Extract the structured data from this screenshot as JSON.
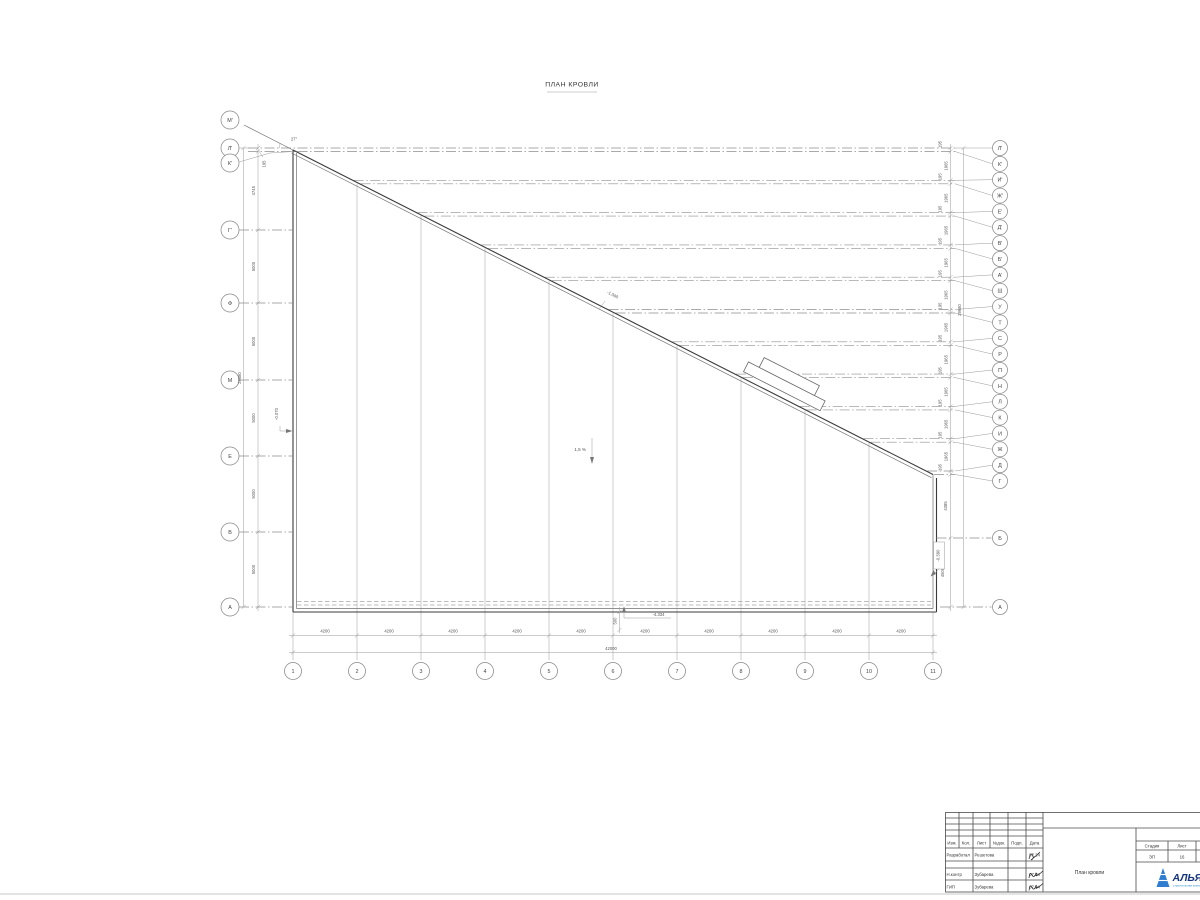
{
  "title": "ПЛАН КРОВЛИ",
  "axes": {
    "left": [
      "М'",
      "Л'",
      "К'",
      "Г'",
      "Ф",
      "М",
      "Е",
      "В",
      "А"
    ],
    "right": [
      "Л'",
      "К'",
      "И'",
      "Ж'",
      "Е'",
      "Д'",
      "В'",
      "Б'",
      "А'",
      "Ш",
      "У",
      "Т",
      "С",
      "Р",
      "П",
      "Н",
      "Л",
      "К",
      "И",
      "Ж",
      "Д",
      "Г"
    ],
    "right_lower": [
      "Б",
      "А"
    ],
    "bottom": [
      "1",
      "2",
      "3",
      "4",
      "5",
      "6",
      "7",
      "8",
      "9",
      "10",
      "11"
    ]
  },
  "dims": {
    "left_chain": [
      "195",
      "4745",
      "5000",
      "5000",
      "5000",
      "5000",
      "5000"
    ],
    "left_total": "29680",
    "right_pair": "195",
    "right_gap": "1965",
    "right_lower": [
      "4385",
      "4500"
    ],
    "right_total": "29680",
    "bottom_bay": "4200",
    "bottom_total": "42000",
    "parapet": "500"
  },
  "annotations": {
    "angle": "27°",
    "slope": "1,5 %",
    "elev_slope": "-1.090",
    "elev_eave": "-4.334",
    "elev_left": "-0.070",
    "elev_right": "-0.590"
  },
  "titleblock": {
    "cols": [
      "Изм.",
      "Кол.",
      "Лист",
      "№док.",
      "Подп.",
      "Дата"
    ],
    "rows": [
      {
        "role": "Разработал",
        "name": "Решетова",
        "date": "07.24"
      },
      {
        "role": "Н.контр",
        "name": "Зубарева",
        "date": "07.24"
      },
      {
        "role": "ГИП",
        "name": "Зубарева",
        "date": "07.24"
      }
    ],
    "doc_title": "План кровли",
    "stage_label": "Стадия",
    "sheet_label": "Лист",
    "sheets_label": "Листов",
    "stage": "ЭП",
    "sheet": "16",
    "logo_text": "АЛЬЯНС",
    "logo_sub": "строительная компания"
  }
}
